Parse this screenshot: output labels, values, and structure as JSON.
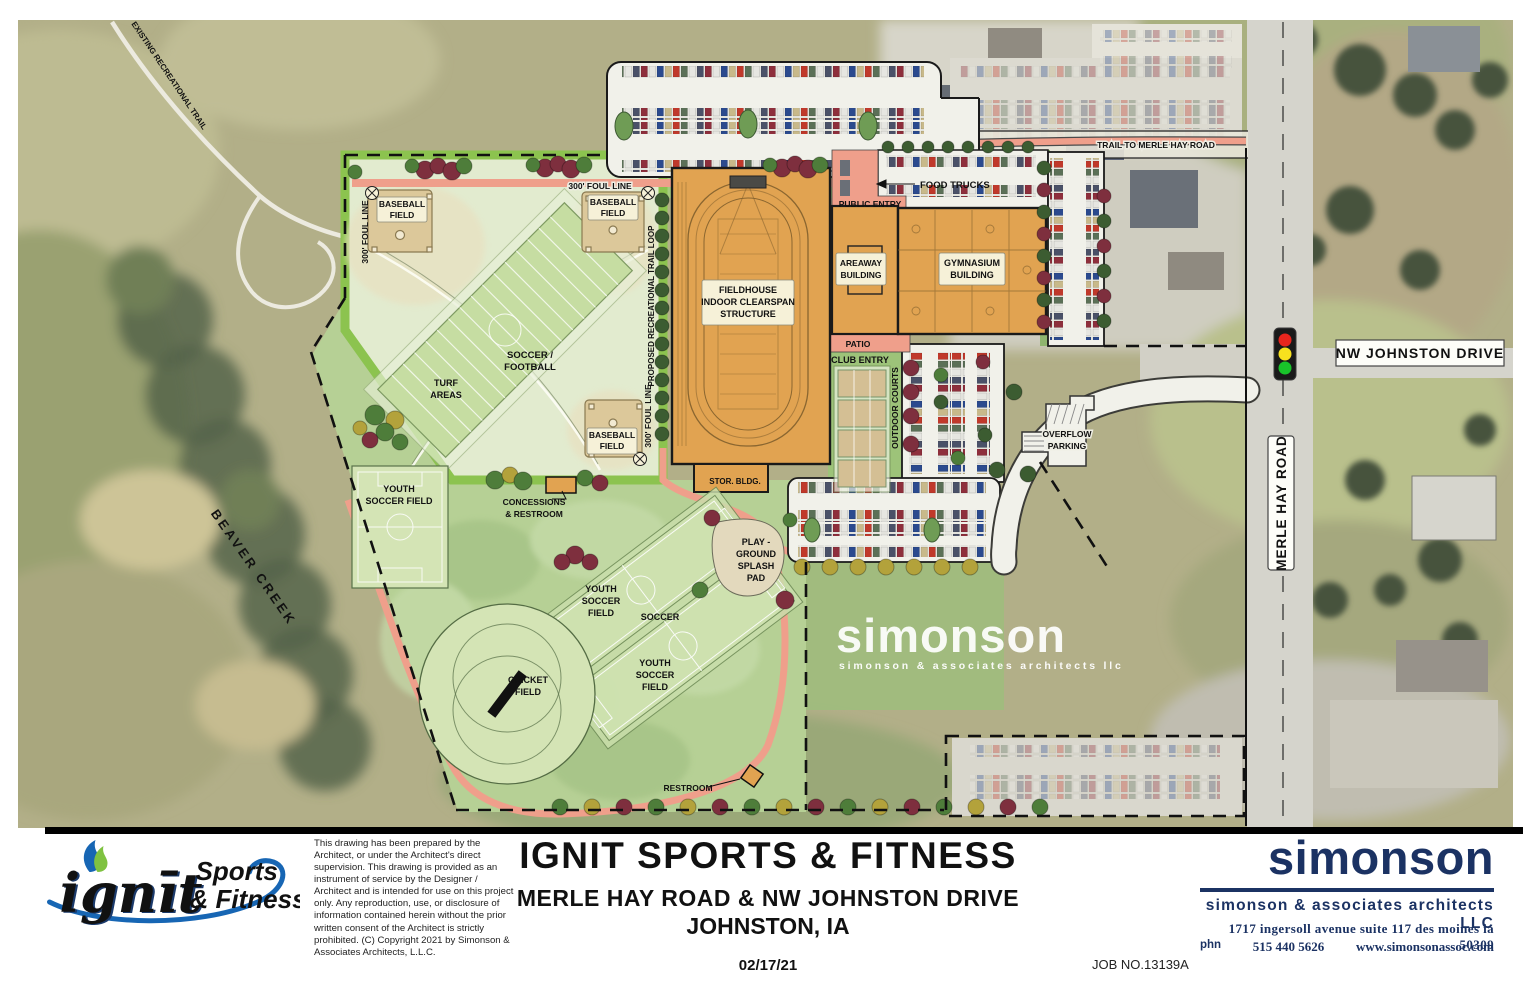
{
  "title_block": {
    "project": "IGNIT SPORTS & FITNESS",
    "address_line": "MERLE HAY ROAD & NW JOHNSTON DRIVE",
    "city_line": "JOHNSTON, IA",
    "date": "02/17/21",
    "job_no": "JOB NO.13139A",
    "disclaimer": "This drawing has been prepared by the Architect, or under the Architect's direct supervision.  This drawing is provided as an instrument of service by the Designer / Architect and is intended for use on this project only. Any reproduction, use, or disclosure of information  contained herein without the prior written consent of the Architect is strictly prohibited. (C) Copyright 2021 by Simonson & Associates Architects, L.L.C."
  },
  "ignit_logo": {
    "wordmark": "ignīt",
    "tagline_1": "Sports",
    "tagline_2": "& Fitness"
  },
  "simonson": {
    "wordmark": "simonson",
    "firm": "simonson & associates architects LLC",
    "address": "1717 ingersoll avenue suite 117 des moines ia  50309",
    "phone_label": "phn",
    "phone": "515 440 5626",
    "website": "www.simonsonassoc.com"
  },
  "watermark": {
    "wordmark": "simonson",
    "firm": "simonson & associates architects llc"
  },
  "roads": {
    "merle_hay": "MERLE HAY ROAD",
    "nw_johnston": "NW JOHNSTON DRIVE",
    "trail_to_merle_hay": "TRAIL TO MERLE HAY ROAD",
    "existing_trail": "EXISTING RECREATIONAL TRAIL",
    "beaver_creek": "BEAVER CREEK"
  },
  "site": {
    "foul_line": "300' FOUL LINE",
    "baseball_field": [
      "BASEBALL",
      "FIELD"
    ],
    "soccer_football": [
      "SOCCER /",
      "FOOTBALL"
    ],
    "turf_areas": [
      "TURF",
      "AREAS"
    ],
    "proposed_trail": "PROPOSED RECREATIONAL TRAIL LOOP",
    "fieldhouse": [
      "FIELDHOUSE",
      "INDOOR CLEARSPAN",
      "STRUCTURE"
    ],
    "areaway": [
      "AREAWAY",
      "BUILDING"
    ],
    "gymnasium": [
      "GYMNASIUM",
      "BUILDING"
    ],
    "food_trucks": "FOOD TRUCKS",
    "public_entry": "PUBLIC ENTRY",
    "patio": "PATIO",
    "club_entry": "CLUB ENTRY",
    "outdoor_courts": "OUTDOOR COURTS",
    "overflow_parking": [
      "OVERFLOW",
      "PARKING"
    ],
    "stor_bldg": "STOR. BLDG.",
    "youth_soccer_2": [
      "YOUTH",
      "SOCCER FIELD"
    ],
    "youth_soccer_3": [
      "YOUTH",
      "SOCCER",
      "FIELD"
    ],
    "soccer": "SOCCER",
    "playground": [
      "PLAY -",
      "GROUND",
      "SPLASH",
      "PAD"
    ],
    "cricket": [
      "CRICKET",
      "FIELD"
    ],
    "restroom": "RESTROOM",
    "concessions": [
      "CONCESSIONS",
      "& RESTROOM"
    ]
  },
  "colors": {
    "building": "#e1a351",
    "trail_salmon": "#ef9f8b",
    "brand_navy": "#1b3263",
    "ignit_green": "#7fc241",
    "ignit_blue": "#1766b4",
    "signal_red": "#e8251d",
    "signal_yellow": "#f7e11e",
    "signal_green": "#18c32a"
  }
}
